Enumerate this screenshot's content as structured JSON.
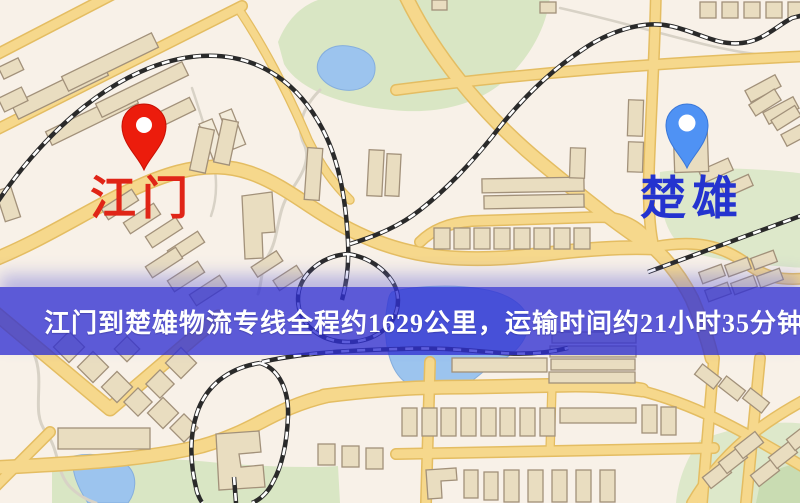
{
  "banner": {
    "text": "江门到楚雄物流专线全程约1629公里，运输时间约21小时35分钟.",
    "background_color": "#5c5cd8",
    "text_color": "#ffffff"
  },
  "markers": {
    "origin": {
      "label": "江门",
      "pin_color": "#ec1c0c",
      "label_color": "#e02517"
    },
    "destination": {
      "label": "楚雄",
      "pin_color": "#4f92f4",
      "label_color": "#2433cf"
    }
  },
  "route": {
    "distance_km": "1629",
    "duration": "21小时35分钟"
  },
  "map_palette": {
    "background": "#f8f1e8",
    "road_fill": "#f6d88c",
    "road_casing": "#e4bd62",
    "park": "#d9e6c4",
    "water": "#9cc4ee",
    "railway": "#2a2a2a",
    "building": "#e9ddc0"
  }
}
